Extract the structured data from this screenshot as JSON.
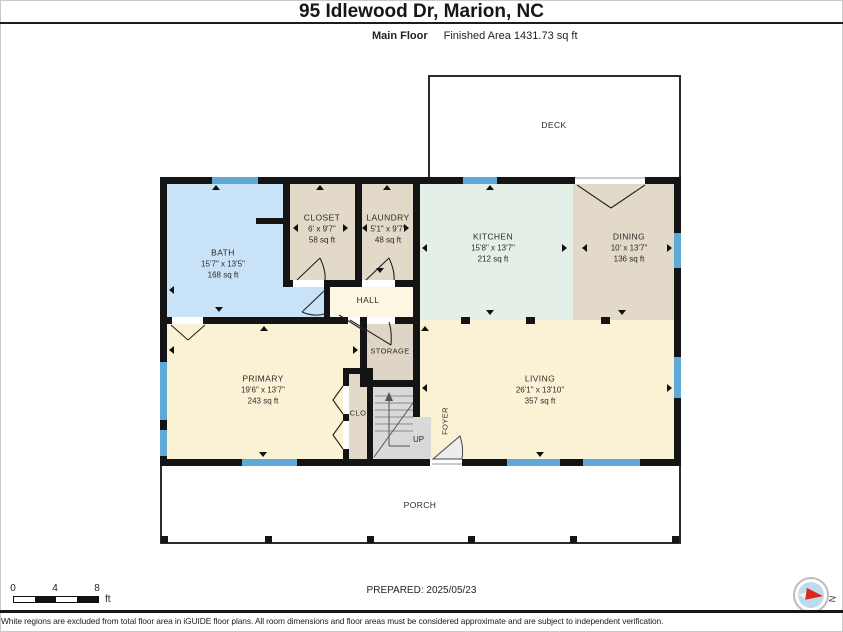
{
  "header": {
    "title": "95 Idlewood Dr, Marion, NC",
    "floor_label": "Main Floor",
    "area_label": "Finished Area 1431.73 sq ft"
  },
  "rooms": {
    "deck": {
      "name": "DECK"
    },
    "porch": {
      "name": "PORCH"
    },
    "bath": {
      "name": "BATH",
      "dims": "15'7\" x 13'5\"",
      "area": "168 sq ft"
    },
    "closet": {
      "name": "CLOSET",
      "dims": "6' x 9'7\"",
      "area": "58 sq ft"
    },
    "laundry": {
      "name": "LAUNDRY",
      "dims": "5'1\" x 9'7\"",
      "area": "48 sq ft"
    },
    "kitchen": {
      "name": "KITCHEN",
      "dims": "15'8\" x 13'7\"",
      "area": "212 sq ft"
    },
    "dining": {
      "name": "DINING",
      "dims": "10' x 13'7\"",
      "area": "136 sq ft"
    },
    "hall": {
      "name": "HALL"
    },
    "storage": {
      "name": "STORAGE"
    },
    "primary": {
      "name": "PRIMARY",
      "dims": "19'6\" x 13'7\"",
      "area": "243 sq ft"
    },
    "living": {
      "name": "LIVING",
      "dims": "26'1\" x 13'10\"",
      "area": "357 sq ft"
    },
    "clo": {
      "name": "CLO"
    },
    "foyer": {
      "name": "FOYER"
    },
    "stairs": {
      "up_label": "UP"
    }
  },
  "scale_bar": {
    "t0": "0",
    "t4": "4",
    "t8": "8",
    "unit": "ft"
  },
  "footer": {
    "prepared": "PREPARED: 2025/05/23",
    "compass_label": "N",
    "disclaimer": "White regions are excluded from total floor area in iGUIDE floor plans. All room dimensions and floor areas must be considered approximate and are subject to independent verification."
  },
  "colors": {
    "wall": "#141414",
    "window": "#5ea9d8",
    "bath_fill": "#c8e3f7",
    "kitchen_fill": "#e4efe7",
    "dining_fill": "#e2d9c9",
    "closet_fill": "#e2d9c9",
    "bedroom_fill": "#fbf2d6",
    "hall_fill": "#fdf6e2",
    "storage_fill": "#ded5c6",
    "stairs_fill": "#d9d9d9",
    "compass_north": "#da291c"
  }
}
